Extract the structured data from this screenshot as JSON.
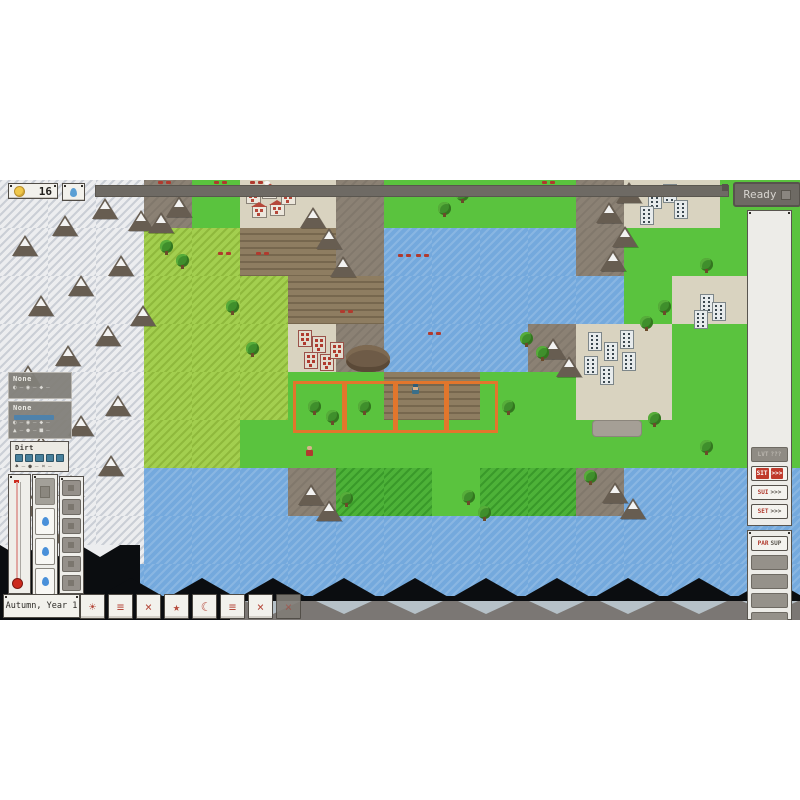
{
  "hud": {
    "gold_value": "16",
    "coin_icon": "coin-icon",
    "water_icon": "drop-icon",
    "ready_label": "Ready",
    "season_label": "Autumn, Year 1"
  },
  "toolbar_buttons": [
    {
      "id": "sun",
      "glyph": "☀",
      "disabled": false
    },
    {
      "id": "menu",
      "glyph": "≡",
      "disabled": false
    },
    {
      "id": "close",
      "glyph": "×",
      "disabled": false
    },
    {
      "id": "star",
      "glyph": "★",
      "disabled": false
    },
    {
      "id": "moon",
      "glyph": "☾",
      "disabled": false
    },
    {
      "id": "menu-2",
      "glyph": "≡",
      "disabled": false
    },
    {
      "id": "close-2",
      "glyph": "×",
      "disabled": false
    },
    {
      "id": "extra",
      "glyph": "×",
      "disabled": true
    }
  ],
  "left_panels": [
    {
      "title": "None",
      "style": "dark",
      "rows": [
        [
          "◐",
          "◉",
          "◆"
        ]
      ]
    },
    {
      "title": "None",
      "style": "dark",
      "rows": [
        [
          "◐",
          "◉",
          "◆"
        ],
        [
          "▲",
          "●",
          "■"
        ]
      ],
      "has_selection_bar": true
    },
    {
      "title": "Dirt",
      "style": "light",
      "meter_cells": 5,
      "rows": [
        [
          "♠",
          "●",
          "¤"
        ]
      ]
    }
  ],
  "left_column": {
    "drop_cells": 3,
    "tool_buttons": 7
  },
  "right_panel": {
    "buttons": [
      {
        "label": "LVT",
        "suffix": "???",
        "style": "disabled"
      },
      {
        "label": "SIT",
        "suffix": ">>>",
        "style": "red"
      },
      {
        "label": "SUI",
        "suffix": ">>>",
        "style": "light"
      },
      {
        "label": "SET",
        "suffix": ">>>",
        "style": "light"
      }
    ],
    "lower_buttons": [
      {
        "label": "PAR",
        "suffix": "SUP",
        "style": "light"
      },
      {
        "label": "",
        "suffix": "",
        "style": "blank"
      },
      {
        "label": "",
        "suffix": "",
        "style": "blank"
      },
      {
        "label": "",
        "suffix": "",
        "style": "blank"
      },
      {
        "label": "",
        "suffix": "",
        "style": "blank"
      }
    ]
  },
  "colors": {
    "accent_red": "#b5483a",
    "ui_dark": "#6e6a64",
    "water": "#74a9dd",
    "grass_bright": "#5ac33e",
    "grass_light": "#a3cf4f",
    "dirt": "#8e7d61",
    "snow": "#ecedef",
    "selection_orange": "#e2762c",
    "drop_blue": "#4a90d9"
  },
  "map": {
    "tile_size": 48,
    "origin_y": 180,
    "grid": [
      "SSSRgVVRggggRVVgg",
      "SSSGGDDRWWWWRgggg",
      "SSSGGGDDWWWWWgVVg",
      "SSSGGGVRWWWRVVggg",
      "SSSGGGggDDggVVggg",
      "SSSGGgggggggggggg",
      "SSSWWWRddgddRWWWW",
      "SSSWWWWWWWWWWWWWW",
      "WWWWWWWWWWWWWWWWW"
    ],
    "selection": {
      "x": 293,
      "y": 381,
      "cells": 4,
      "cell_w": 51,
      "cell_h": 52
    },
    "features": {
      "mtn": [
        [
          12,
          235
        ],
        [
          52,
          215
        ],
        [
          92,
          198
        ],
        [
          128,
          210
        ],
        [
          28,
          295
        ],
        [
          68,
          275
        ],
        [
          108,
          255
        ],
        [
          15,
          365
        ],
        [
          55,
          345
        ],
        [
          95,
          325
        ],
        [
          130,
          305
        ],
        [
          28,
          435
        ],
        [
          68,
          415
        ],
        [
          105,
          395
        ],
        [
          18,
          495
        ],
        [
          58,
          475
        ],
        [
          98,
          455
        ],
        [
          38,
          522
        ],
        [
          148,
          212
        ],
        [
          166,
          196
        ],
        [
          300,
          207
        ],
        [
          316,
          228
        ],
        [
          330,
          256
        ],
        [
          540,
          338
        ],
        [
          556,
          356
        ],
        [
          596,
          202
        ],
        [
          612,
          226
        ],
        [
          600,
          250
        ],
        [
          616,
          182
        ],
        [
          298,
          484
        ],
        [
          316,
          500
        ],
        [
          602,
          482
        ],
        [
          620,
          498
        ]
      ],
      "tr": [
        [
          160,
          240
        ],
        [
          176,
          254
        ],
        [
          226,
          300
        ],
        [
          246,
          342
        ],
        [
          308,
          400
        ],
        [
          326,
          410
        ],
        [
          358,
          400
        ],
        [
          502,
          400
        ],
        [
          456,
          188
        ],
        [
          438,
          202
        ],
        [
          520,
          332
        ],
        [
          536,
          346
        ],
        [
          658,
          300
        ],
        [
          640,
          316
        ],
        [
          700,
          258
        ],
        [
          584,
          470
        ],
        [
          462,
          490
        ],
        [
          478,
          506
        ],
        [
          648,
          412
        ],
        [
          700,
          440
        ],
        [
          340,
          492
        ]
      ],
      "hs": [
        [
          246,
          192
        ],
        [
          262,
          187
        ],
        [
          252,
          206
        ],
        [
          270,
          204
        ],
        [
          281,
          193
        ]
      ],
      "rb": [
        [
          298,
          330
        ],
        [
          312,
          336
        ],
        [
          304,
          352
        ],
        [
          320,
          354
        ],
        [
          330,
          342
        ]
      ],
      "ap": [
        [
          648,
          190
        ],
        [
          663,
          184
        ],
        [
          674,
          200
        ],
        [
          640,
          206
        ],
        [
          700,
          294
        ],
        [
          694,
          310
        ],
        [
          588,
          332
        ],
        [
          604,
          342
        ],
        [
          620,
          330
        ],
        [
          584,
          356
        ],
        [
          600,
          366
        ],
        [
          622,
          352
        ],
        [
          712,
          302
        ]
      ],
      "cr": [
        [
          218,
          252
        ],
        [
          256,
          252
        ],
        [
          398,
          254
        ],
        [
          416,
          254
        ],
        [
          340,
          310
        ],
        [
          428,
          332
        ],
        [
          158,
          181
        ],
        [
          214,
          181
        ],
        [
          250,
          181
        ],
        [
          542,
          181
        ]
      ],
      "st": [
        [
          592,
          420
        ]
      ],
      "md": [
        [
          346,
          345
        ]
      ],
      "unitb": [
        [
          412,
          388
        ]
      ],
      "unitr": [
        [
          306,
          450
        ]
      ],
      "bd": [
        [
          264,
          181
        ]
      ]
    }
  }
}
